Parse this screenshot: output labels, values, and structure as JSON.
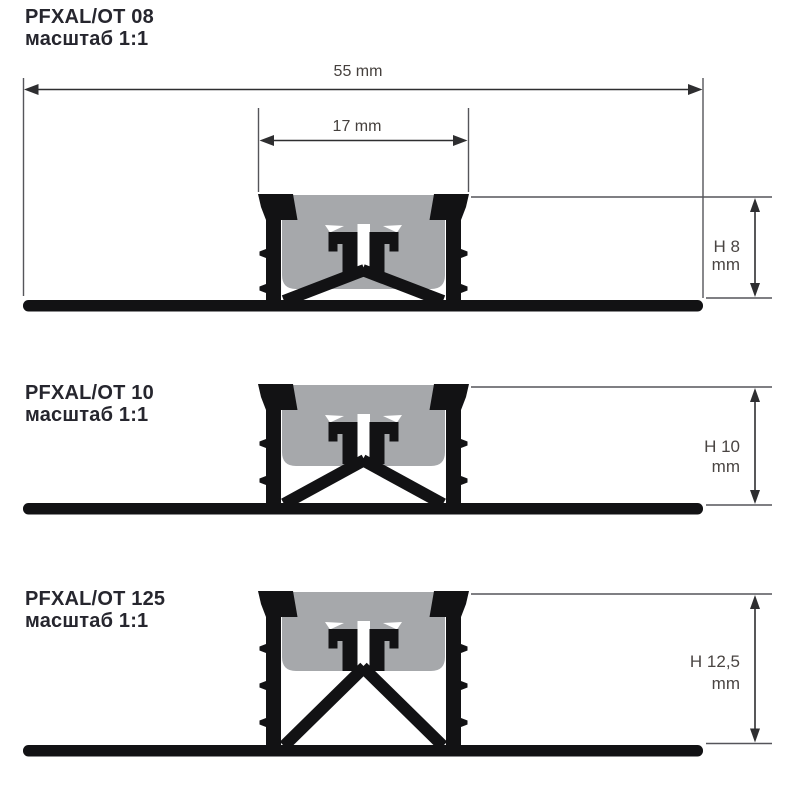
{
  "sheet": {
    "width": 800,
    "height": 800,
    "background": "#ffffff"
  },
  "colors": {
    "background": "#ffffff",
    "profile": "#121214",
    "insert": "#a6a8ab",
    "dim_line": "#2e2e30",
    "ext_line": "#55555a",
    "dim_text": "#45403d",
    "title_text": "#26262e"
  },
  "dimensions": {
    "total_width": {
      "label": "55 mm",
      "value_mm": 55
    },
    "insert_width": {
      "label": "17 mm",
      "value_mm": 17
    }
  },
  "profiles": [
    {
      "name": "PFXAL/OT 08",
      "scale_label": "масштаб 1:1",
      "h_value": "H 8",
      "unit": "mm",
      "height_mm": 8,
      "geometry": {
        "top": 194,
        "base_top": 300,
        "ext_bottom": 298,
        "gray_depth": 95,
        "barb_offsets": [
          55,
          90
        ]
      }
    },
    {
      "name": "PFXAL/OT 10",
      "scale_label": "масштаб 1:1",
      "h_value": "H 10",
      "unit": "mm",
      "height_mm": 10,
      "geometry": {
        "top": 384,
        "base_top": 503,
        "ext_bottom": 505,
        "gray_depth": 82,
        "barb_offsets": [
          55,
          92
        ]
      }
    },
    {
      "name": "PFXAL/OT 125",
      "scale_label": "масштаб 1:1",
      "h_value": "H 12,5",
      "unit": "mm",
      "height_mm": 12.5,
      "geometry": {
        "top": 591,
        "base_top": 745,
        "ext_bottom": 743.5,
        "gray_depth": 80,
        "barb_offsets": [
          53,
          90,
          127
        ]
      }
    }
  ]
}
